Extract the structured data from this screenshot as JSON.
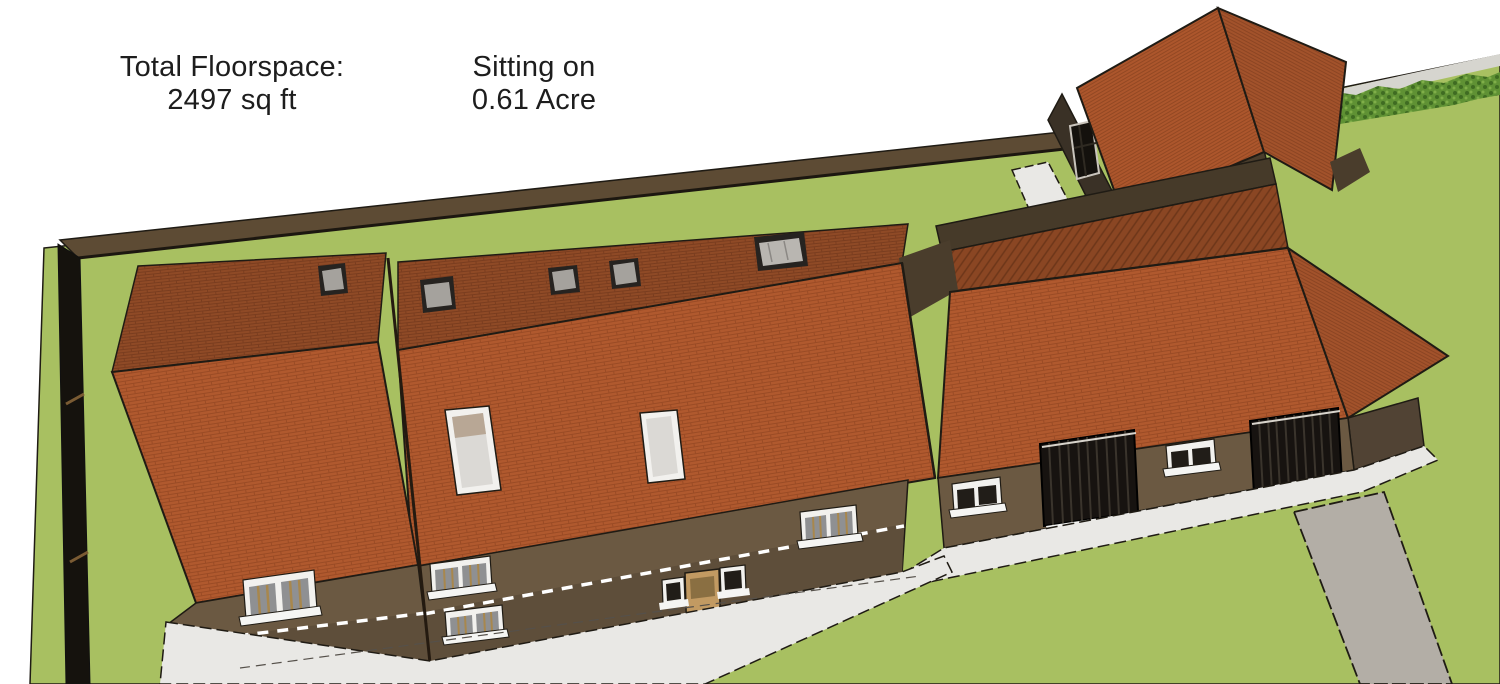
{
  "annotations": {
    "floorspace": {
      "label": "Total Floorspace:",
      "value": "2497 sq ft"
    },
    "plot": {
      "label": "Sitting on",
      "value": "0.61 Acre"
    }
  },
  "colors": {
    "bg": "#ffffff",
    "text": "#1d1d1d",
    "lawn": "#a8c061",
    "hedge": "#5f9134",
    "hedge-dark": "#3f6b22",
    "hedge-light": "#7fae49",
    "pale-band": "#d6d5cf",
    "roof-front": "#b0592e",
    "roof-front-line": "#9a4b25",
    "roof-back": "#8f4a26",
    "roof-back-line": "#7a3d1f",
    "roof-hip": "#a2522b",
    "roof-hip-line": "#8c4523",
    "roof-ob": "#ac562c",
    "roof-ob-line": "#934823",
    "roof-hatch": "#8a4623",
    "roof-hatch-line": "#6d3619",
    "wall-front": "#6b5942",
    "wall-lower": "#5e4e3a",
    "wall-dark": "#4a3d2c",
    "wall-darker": "#3a3126",
    "wall-strip": "#463a29",
    "wall-end": "#514334",
    "boundary-wall": "#5d4b34",
    "west-wall": "#15120d",
    "path": "#e9e8e5",
    "driveway": "#b3aea6",
    "garage": "#171310",
    "garage-slat": "#3a342c",
    "garage-glint": "#d8d4cc",
    "win-frame": "#f2f1ee",
    "win-glass": "#8f9092",
    "win-glass-dark": "#211d18",
    "glazing": "#a8874d",
    "sill": "#f5f5f3",
    "roofwin-glass": "#dbd9d5",
    "roofwin-top": "#b8a795",
    "sky-frame": "#262320",
    "sky-glass": "#a5a29d",
    "skybig-glass": "#b9b6b1",
    "door": "#c29a62",
    "door-dark": "#8a6f42",
    "dash": "#ffffff",
    "edge": "#1f1b14"
  }
}
